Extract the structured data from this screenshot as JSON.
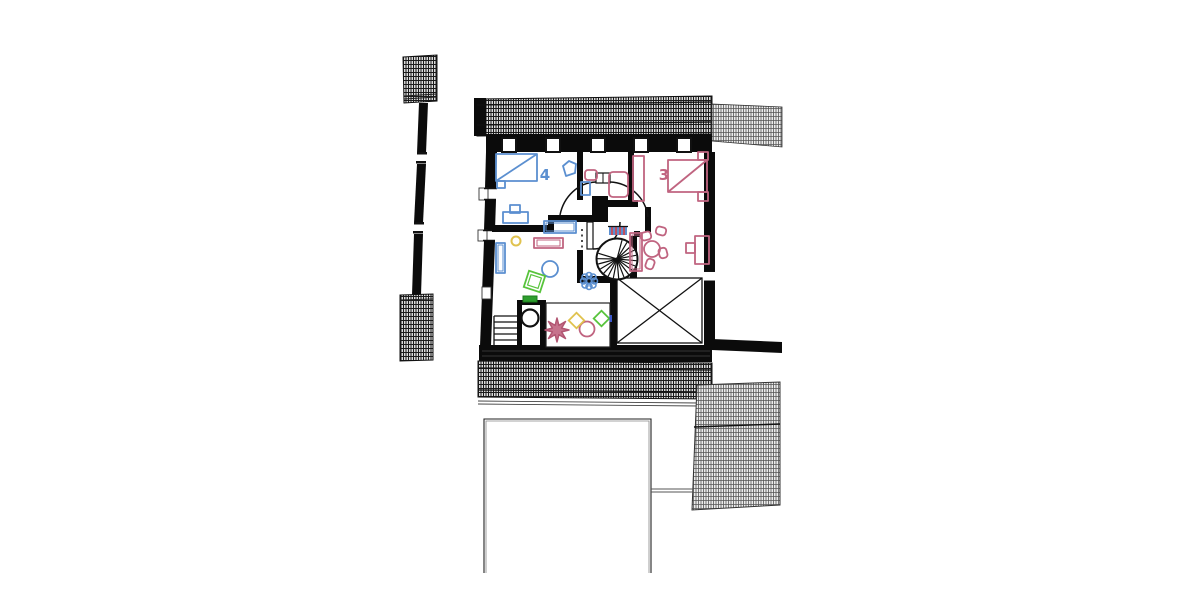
{
  "plan": {
    "title": "attic-floor-plan",
    "rooms": [
      {
        "label": "4",
        "name": "bedroom-4",
        "color": "#5b8fd0"
      },
      {
        "label": "3",
        "name": "bedroom-3",
        "color": "#c06480"
      }
    ],
    "palette": {
      "blue": "#5b8fd0",
      "pink": "#c06480",
      "green": "#58c43c",
      "green_dark": "#2e9e2e",
      "yellow": "#e0c24e",
      "wall_black": "#0b0b0b",
      "roof_hatch_dark": "#1a1a1a",
      "roof_hatch_light": "#555555"
    },
    "features": [
      "spiral-staircase",
      "void-opening-x",
      "double-door-swing",
      "skylight-row",
      "roof-hatch-top",
      "roof-hatch-bottom",
      "roof-panel-lower-right",
      "detached-wall-strip",
      "straight-stairs",
      "play-room-toys",
      "lower-floor-outline"
    ]
  }
}
